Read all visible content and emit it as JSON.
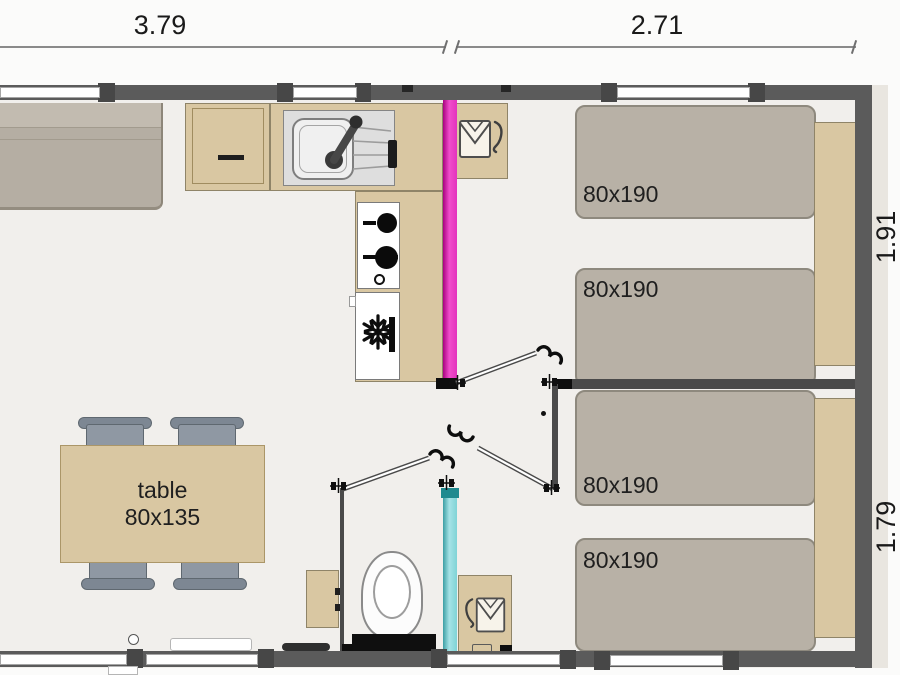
{
  "labels": {
    "dim_top_left": "3.79",
    "dim_top_right": "2.71",
    "dim_right_upper": "1.91",
    "dim_right_lower": "1.79",
    "bed1": "80x190",
    "bed2": "80x190",
    "bed3": "80x190",
    "bed4": "80x190",
    "table_name": "table",
    "table_size": "80x135"
  },
  "icons": {
    "fridge": "snowflake-icon",
    "closet_top": "hanger-shirt-icon",
    "closet_bathroom": "hanger-shirt-icon",
    "sink": "faucet-icon",
    "stove": "burner-icon",
    "interior_doors": "door-swing-icon",
    "wall_joints": "hinge-icon"
  },
  "colors": {
    "wall": "#5b5b5b",
    "wood": "#d9c7a2",
    "bed": "#b8b1a6",
    "sofa": "#b5aea3",
    "chair": "#8f98a3",
    "pink": "#e93cc2",
    "cyan": "#8fd8db",
    "floor": "#f1efec"
  }
}
